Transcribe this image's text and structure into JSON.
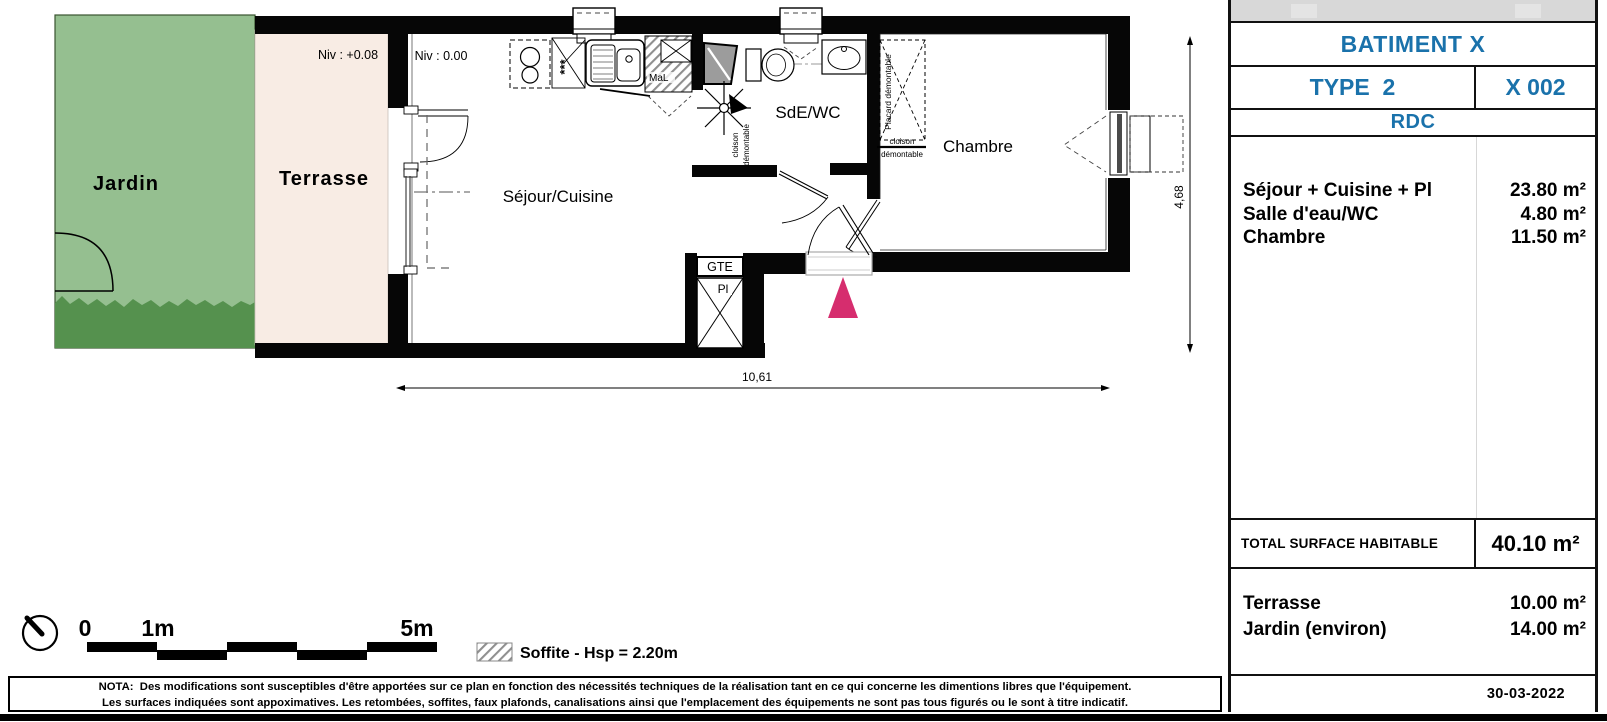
{
  "colors": {
    "accent_blue": "#1a72ab",
    "jardin_green": "#95bf90",
    "hedge_green": "#55914e",
    "terrasse_beige": "#f8ece4",
    "entrance_pink": "#d62d6e"
  },
  "plan": {
    "labels": {
      "jardin": "Jardin",
      "terrasse": "Terrasse",
      "sejour": "Séjour/Cuisine",
      "sde": "SdE/WC",
      "chambre": "Chambre",
      "niv_terrasse": "Niv : +0.08",
      "niv_sejour": "Niv : 0.00",
      "gte": "GTE",
      "pl": "Pl",
      "mal": "MaL",
      "stars": "***",
      "placard": "Placard démontable",
      "cloison": "cloison",
      "demontable": "démontable",
      "dim_width": "10,61",
      "dim_height": "4,68"
    },
    "legend": {
      "scale_0": "0",
      "scale_1": "1m",
      "scale_5": "5m",
      "soffite": "Soffite - Hsp = 2.20m"
    }
  },
  "panel": {
    "batiment": "BATIMENT X",
    "type": "TYPE  2",
    "unit": "X 002",
    "floor": "RDC",
    "rooms": [
      {
        "label": "Séjour + Cuisine + Pl",
        "area": "23.80 m²"
      },
      {
        "label": "Salle d'eau/WC",
        "area": "4.80 m²"
      },
      {
        "label": "Chambre",
        "area": "11.50 m²"
      }
    ],
    "total_label": "TOTAL SURFACE HABITABLE",
    "total_value": "40.10 m²",
    "outdoor": [
      {
        "label": "Terrasse",
        "area": "10.00 m²"
      },
      {
        "label": "Jardin (environ)",
        "area": "14.00 m²"
      }
    ],
    "date": "30-03-2022"
  },
  "nota": {
    "line1": "NOTA:  Des modifications sont susceptibles d'être apportées sur ce plan en fonction des nécessités techniques de la réalisation tant en ce qui concerne les dimentions libres que l'équipement.",
    "line2": "Les surfaces indiquées sont appoximatives. Les retombées, soffites, faux plafonds, canalisations ainsi que l'emplacement des équipements ne sont pas tous figurés ou le sont à titre indicatif."
  }
}
